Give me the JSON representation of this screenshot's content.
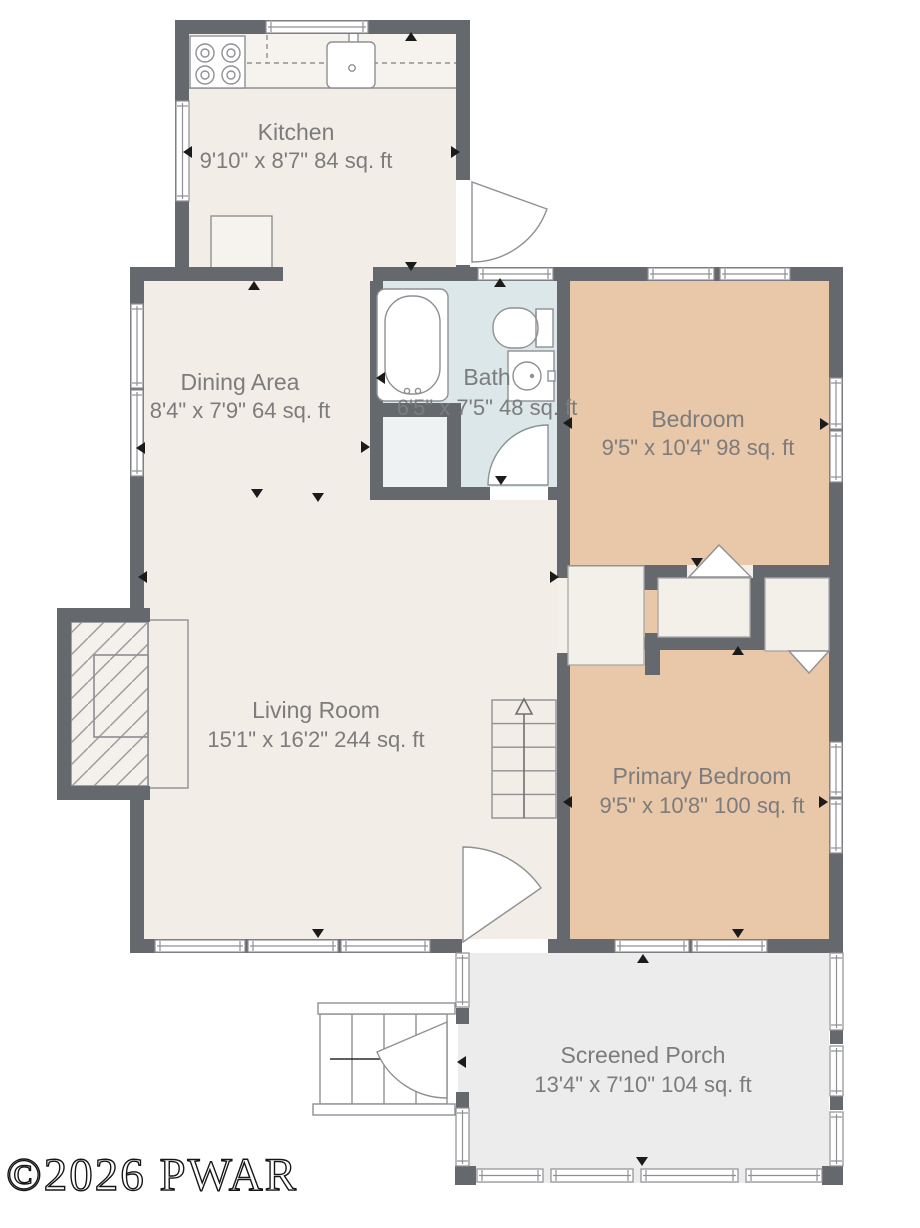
{
  "title": "Floor plan",
  "watermark": "©2026 PWAR",
  "rooms": {
    "kitchen": {
      "name": "Kitchen",
      "dims": "9'10\" x 8'7\" 84 sq. ft"
    },
    "dining_area": {
      "name": "Dining Area",
      "dims": "8'4\" x 7'9\" 64 sq. ft"
    },
    "bath": {
      "name": "Bath",
      "dims": "6'5\" x 7'5\" 48 sq. ft"
    },
    "bedroom": {
      "name": "Bedroom",
      "dims": "9'5\" x 10'4\" 98 sq. ft"
    },
    "living_room": {
      "name": "Living Room",
      "dims": "15'1\" x 16'2\" 244 sq. ft"
    },
    "primary_bedroom": {
      "name": "Primary Bedroom",
      "dims": "9'5\" x 10'8\" 100 sq. ft"
    },
    "screened_porch": {
      "name": "Screened Porch",
      "dims": "13'4\" x 7'10\" 104 sq. ft"
    }
  },
  "colors": {
    "wall": "#65696e",
    "floor_main": "#f2ede6",
    "floor_bedroom": "#e9c7a9",
    "floor_bath": "#dbe7e9",
    "floor_porch": "#ebeceb",
    "line": "#8f9094",
    "label_text": "#7c7c7c",
    "marker": "#1b1b1b",
    "background": "#ffffff"
  }
}
